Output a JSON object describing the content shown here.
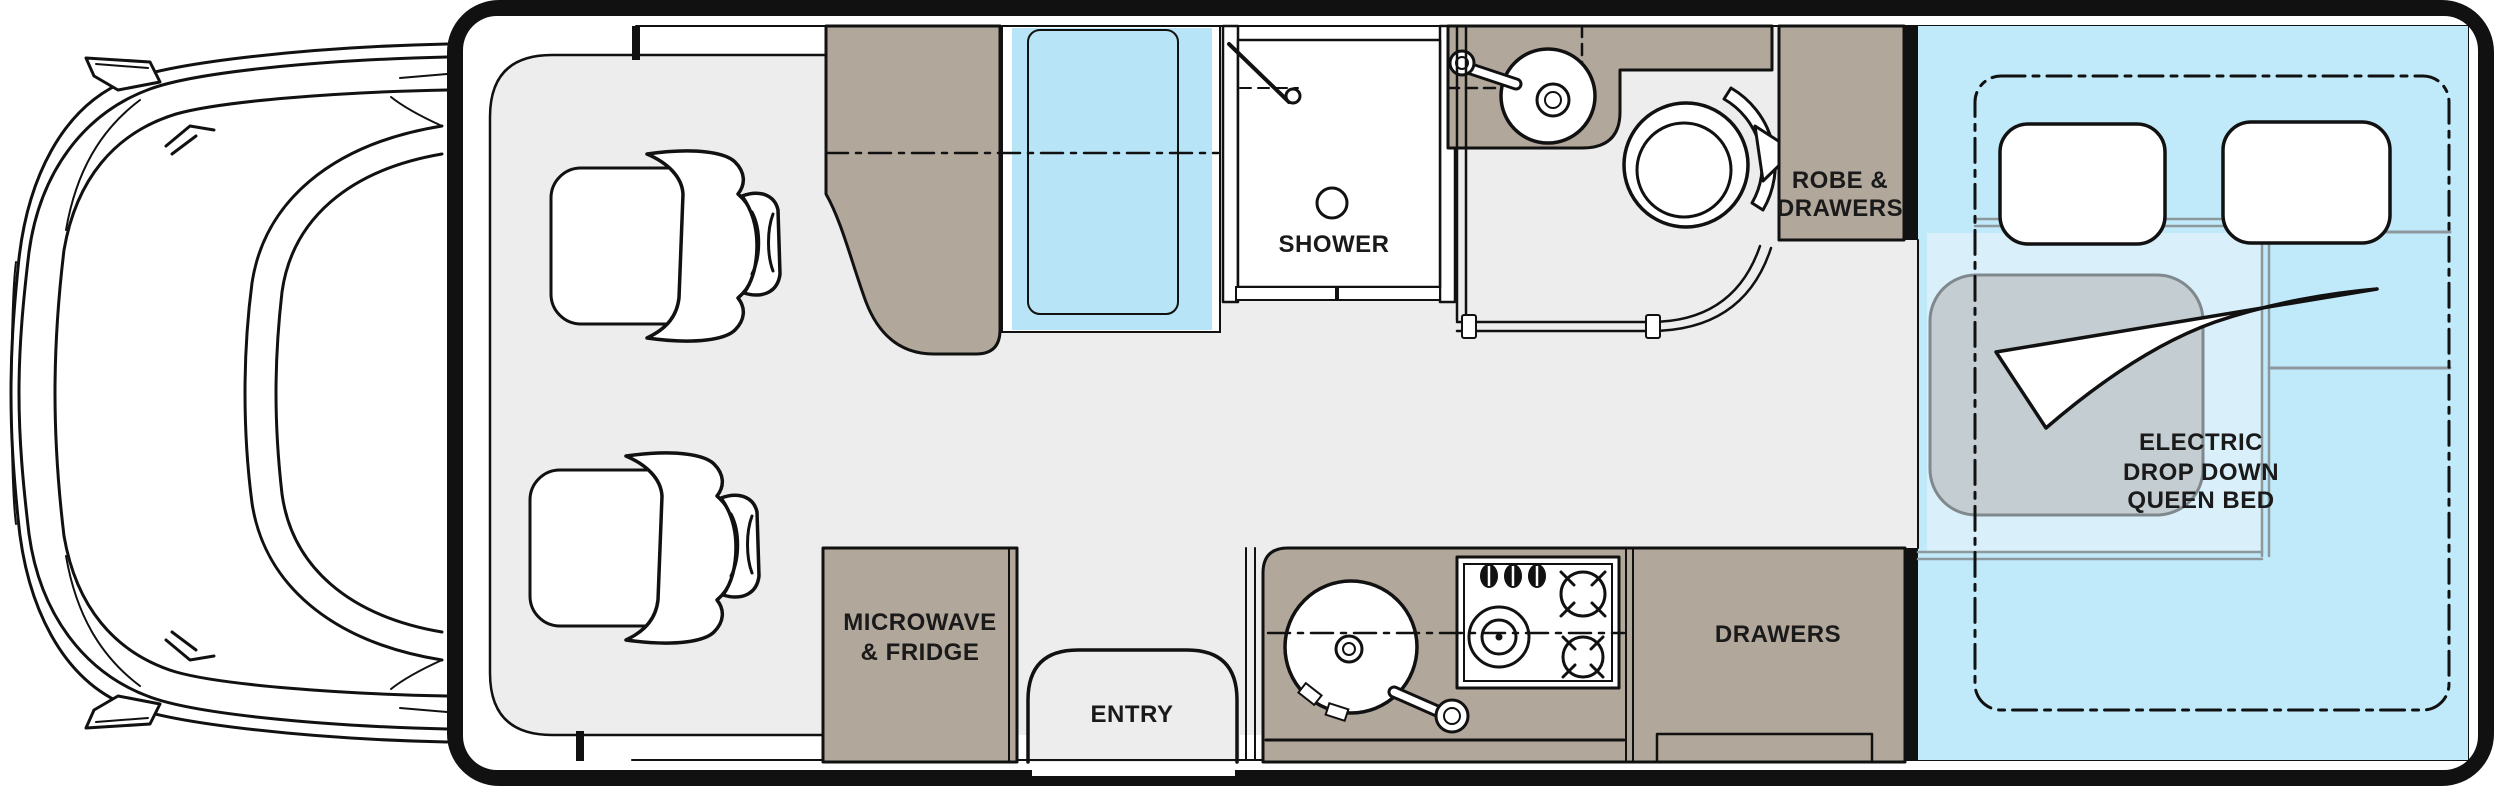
{
  "title": "Motorhome floor plan - electric drop down queen bed layout",
  "colors": {
    "outline": "#111111",
    "floor": "#ededee",
    "cabinet": "#b2a79b",
    "glass": "#b7e5f7",
    "bed_area": "#c0eafa",
    "mattress": "#d9effa",
    "blanket": "#c4ced2",
    "blanket_line": "#7f898d",
    "accent_line": "#8d989c",
    "text": "#1a1a1a"
  },
  "labels": {
    "shower": "SHOWER",
    "robe_line1": "ROBE &",
    "robe_line2": "DRAWERS",
    "bed_line1": "ELECTRIC",
    "bed_line2": "DROP DOWN",
    "bed_line3": "QUEEN BED",
    "microwave_line1": "MICROWAVE",
    "microwave_line2": "& FRIDGE",
    "entry": "ENTRY",
    "drawers": "DRAWERS"
  },
  "fixtures": {
    "cab": "vehicle-cab-icon",
    "seats": "swivel-seat-icon",
    "shower": "shower-drain-icon",
    "toilet": "toilet-icon",
    "bathroom_sink": "round-sink-icon",
    "kitchen_sink": "round-sink-icon",
    "stove": "cooktop-icon",
    "bed": "queen-bed-icon",
    "pillows": "pillow-icon",
    "blanket": "blanket-icon",
    "arrow": "fold-arrow-icon",
    "window": "window-glass"
  }
}
